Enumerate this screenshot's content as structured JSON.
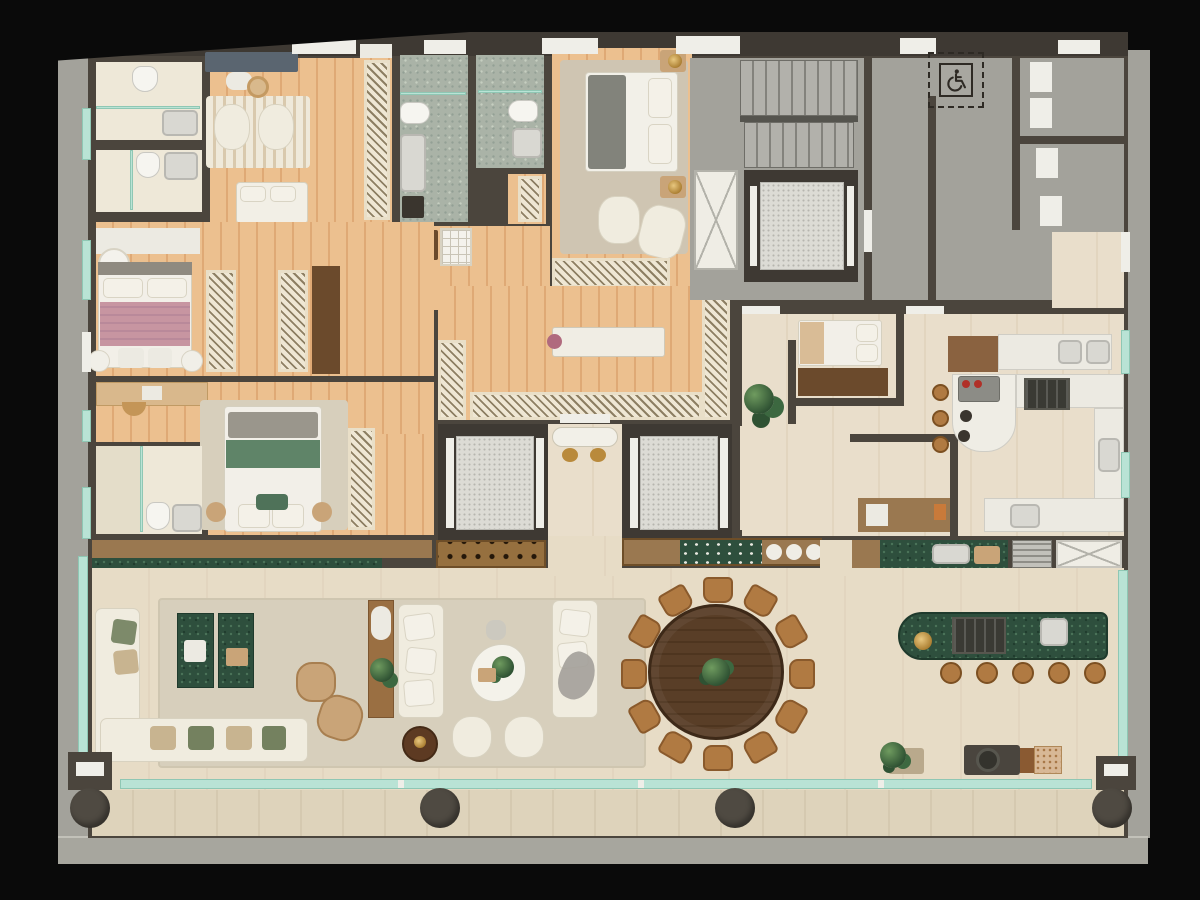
{
  "meta": {
    "type": "rendered residential floor plan (top-down 3D render)",
    "visible_text": "none — plan contains no written labels, only graphics",
    "accessibility_glyph": "wheelchair symbol in dashed service-area box"
  },
  "palette": {
    "bg": "#0a0a0a",
    "wall": "#4b453d",
    "wall2": "#3e3933",
    "concrete": "#a3a29b",
    "conc2": "#908f88",
    "wood": "#ecc08f",
    "woodline": "#dfa975",
    "tile": "#e9decb",
    "tileline": "#e2d5bf",
    "tile2": "#e7dcc6",
    "tile3": "#ded3bb",
    "bathtile": "#eee8d8",
    "glass": "#b9e3d5",
    "marble-white": "#eceae2",
    "marble-green": "#2e4f3d",
    "marble-gray": "#aab3a7",
    "cream": "#f0ecdf",
    "tan": "#c9a478",
    "walnut": "#6b4a2c",
    "wood2": "#9a7850",
    "plant-green": "#3c6840",
    "bed-pink": "#c795a1",
    "bed-green": "#5f8468",
    "rugcol": "#d7cfbc",
    "gold": "#b98a3c",
    "dark": "#35312b"
  },
  "icons": {
    "accessibility": {
      "name": "wheelchair-accessible-icon",
      "style": "dashed outlined box on concrete core"
    }
  },
  "inventory": {
    "bedrooms": 5,
    "bathrooms_full": 5,
    "powder_rooms": 1,
    "private_elevators": 2,
    "service_elevator_shafts": 2,
    "stair_flights": 2,
    "dining_table_seats": 12,
    "gourmet_island_stools": 5,
    "living_sofas": 4,
    "balcony_columns": 4,
    "walk_in_closet_islands": 1
  }
}
